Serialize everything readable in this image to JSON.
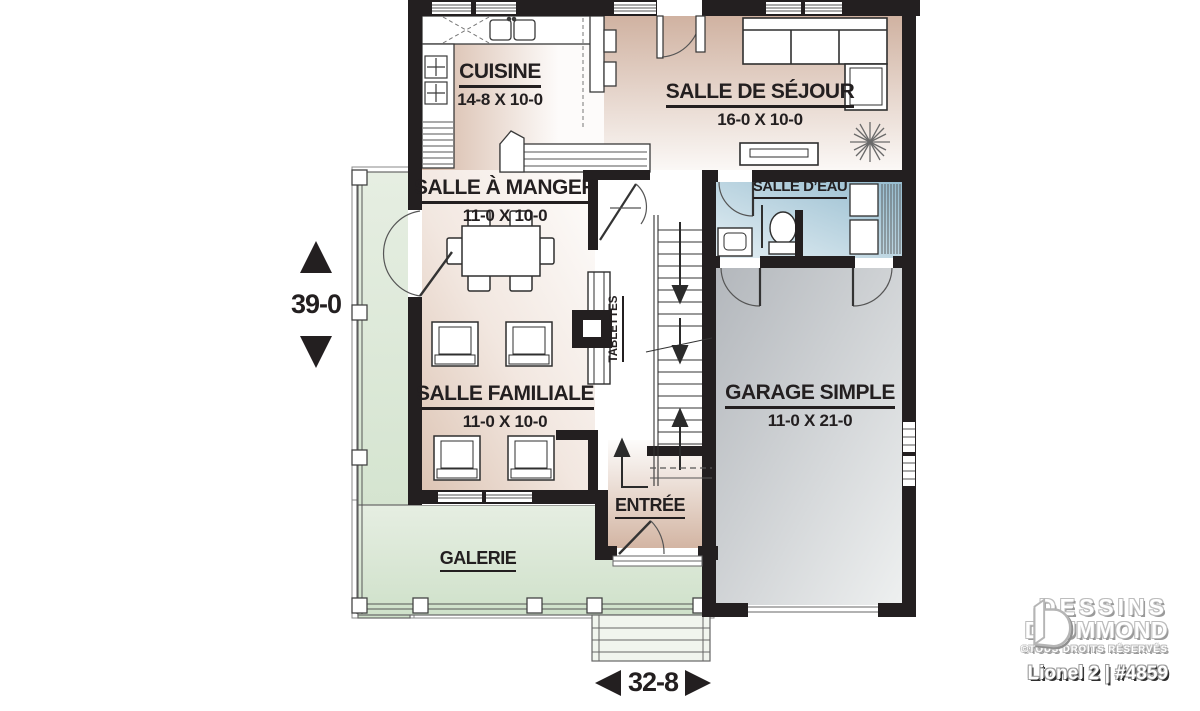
{
  "plan": {
    "rooms": {
      "cuisine": {
        "label": "CUISINE",
        "dims": "14-8 X 10-0"
      },
      "sejour": {
        "label": "SALLE DE SÉJOUR",
        "dims": "16-0 X 10-0"
      },
      "manger": {
        "label": "SALLE À MANGER",
        "dims": "11-0 X 10-0"
      },
      "eau": {
        "label": "SALLE D’EAU"
      },
      "familiale": {
        "label": "SALLE FAMILIALE",
        "dims": "11-0 X 10-0"
      },
      "garage": {
        "label": "GARAGE SIMPLE",
        "dims": "11-0 X 21-0"
      },
      "entree": {
        "label": "ENTRÉE"
      },
      "galerie": {
        "label": "GALERIE"
      },
      "tablettes": {
        "label": "TABLETTES"
      }
    },
    "dimensions": {
      "depth": "39-0",
      "width": "32-8"
    },
    "colors": {
      "wall": "#231f20",
      "floor_beige": "#d5b7a5",
      "porch_green": "#dbe8d6",
      "powder_blue": "#a3c6d6",
      "garage_gray": "#c2c6ca"
    }
  },
  "branding": {
    "line1": "DESSINS",
    "line2": "DRUMMOND",
    "rights": "©TOUS DROITS RÉSERVÉS",
    "model": "Lionel 2 | #4859"
  }
}
